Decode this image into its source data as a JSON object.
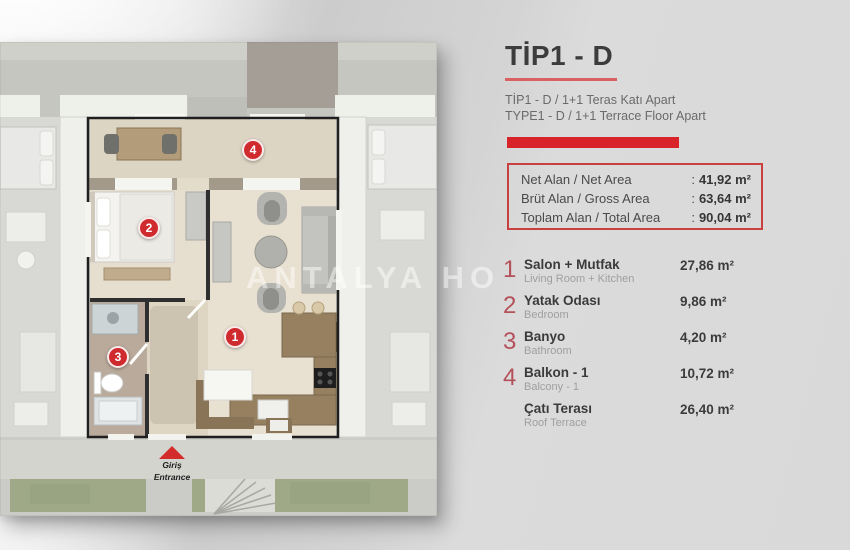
{
  "panel": {
    "title": "TİP1 - D",
    "subtitle_tr": "TİP1 - D / 1+1 Teras Katı Apart",
    "subtitle_en": "TYPE1 - D / 1+1 Terrace Floor Apart",
    "area_box": {
      "colon": ":",
      "rows": [
        {
          "label": "Net Alan / Net Area",
          "value": "41,92 m²"
        },
        {
          "label": "Brüt Alan / Gross Area",
          "value": "63,64 m²"
        },
        {
          "label": "Toplam Alan / Total Area",
          "value": "90,04 m²"
        }
      ]
    },
    "rooms": [
      {
        "num": "1",
        "name_tr": "Salon + Mutfak",
        "name_en": "Living Room + Kitchen",
        "area": "27,86 m²"
      },
      {
        "num": "2",
        "name_tr": "Yatak Odası",
        "name_en": "Bedroom",
        "area": "9,86 m²"
      },
      {
        "num": "3",
        "name_tr": "Banyo",
        "name_en": "Bathroom",
        "area": "4,20 m²"
      },
      {
        "num": "4",
        "name_tr": "Balkon - 1",
        "name_en": "Balcony - 1",
        "area": "10,72 m²"
      },
      {
        "num": "",
        "name_tr": "Çatı Terası",
        "name_en": "Roof Terrace",
        "area": "26,40 m²"
      }
    ]
  },
  "plan": {
    "badge_numbers": [
      "1",
      "2",
      "3",
      "4"
    ],
    "entrance": {
      "label_tr": "Giriş",
      "label_en": "Entrance"
    },
    "watermark": "ANTALYA HO"
  },
  "colors": {
    "accent_red": "#d8232a",
    "badge_red": "#cf2b2f",
    "list_number_red": "#b4505a",
    "panel_gray": "#d9d9d9",
    "floor_beige": "#e8e0d1",
    "lawn_green": "#9fa988"
  }
}
